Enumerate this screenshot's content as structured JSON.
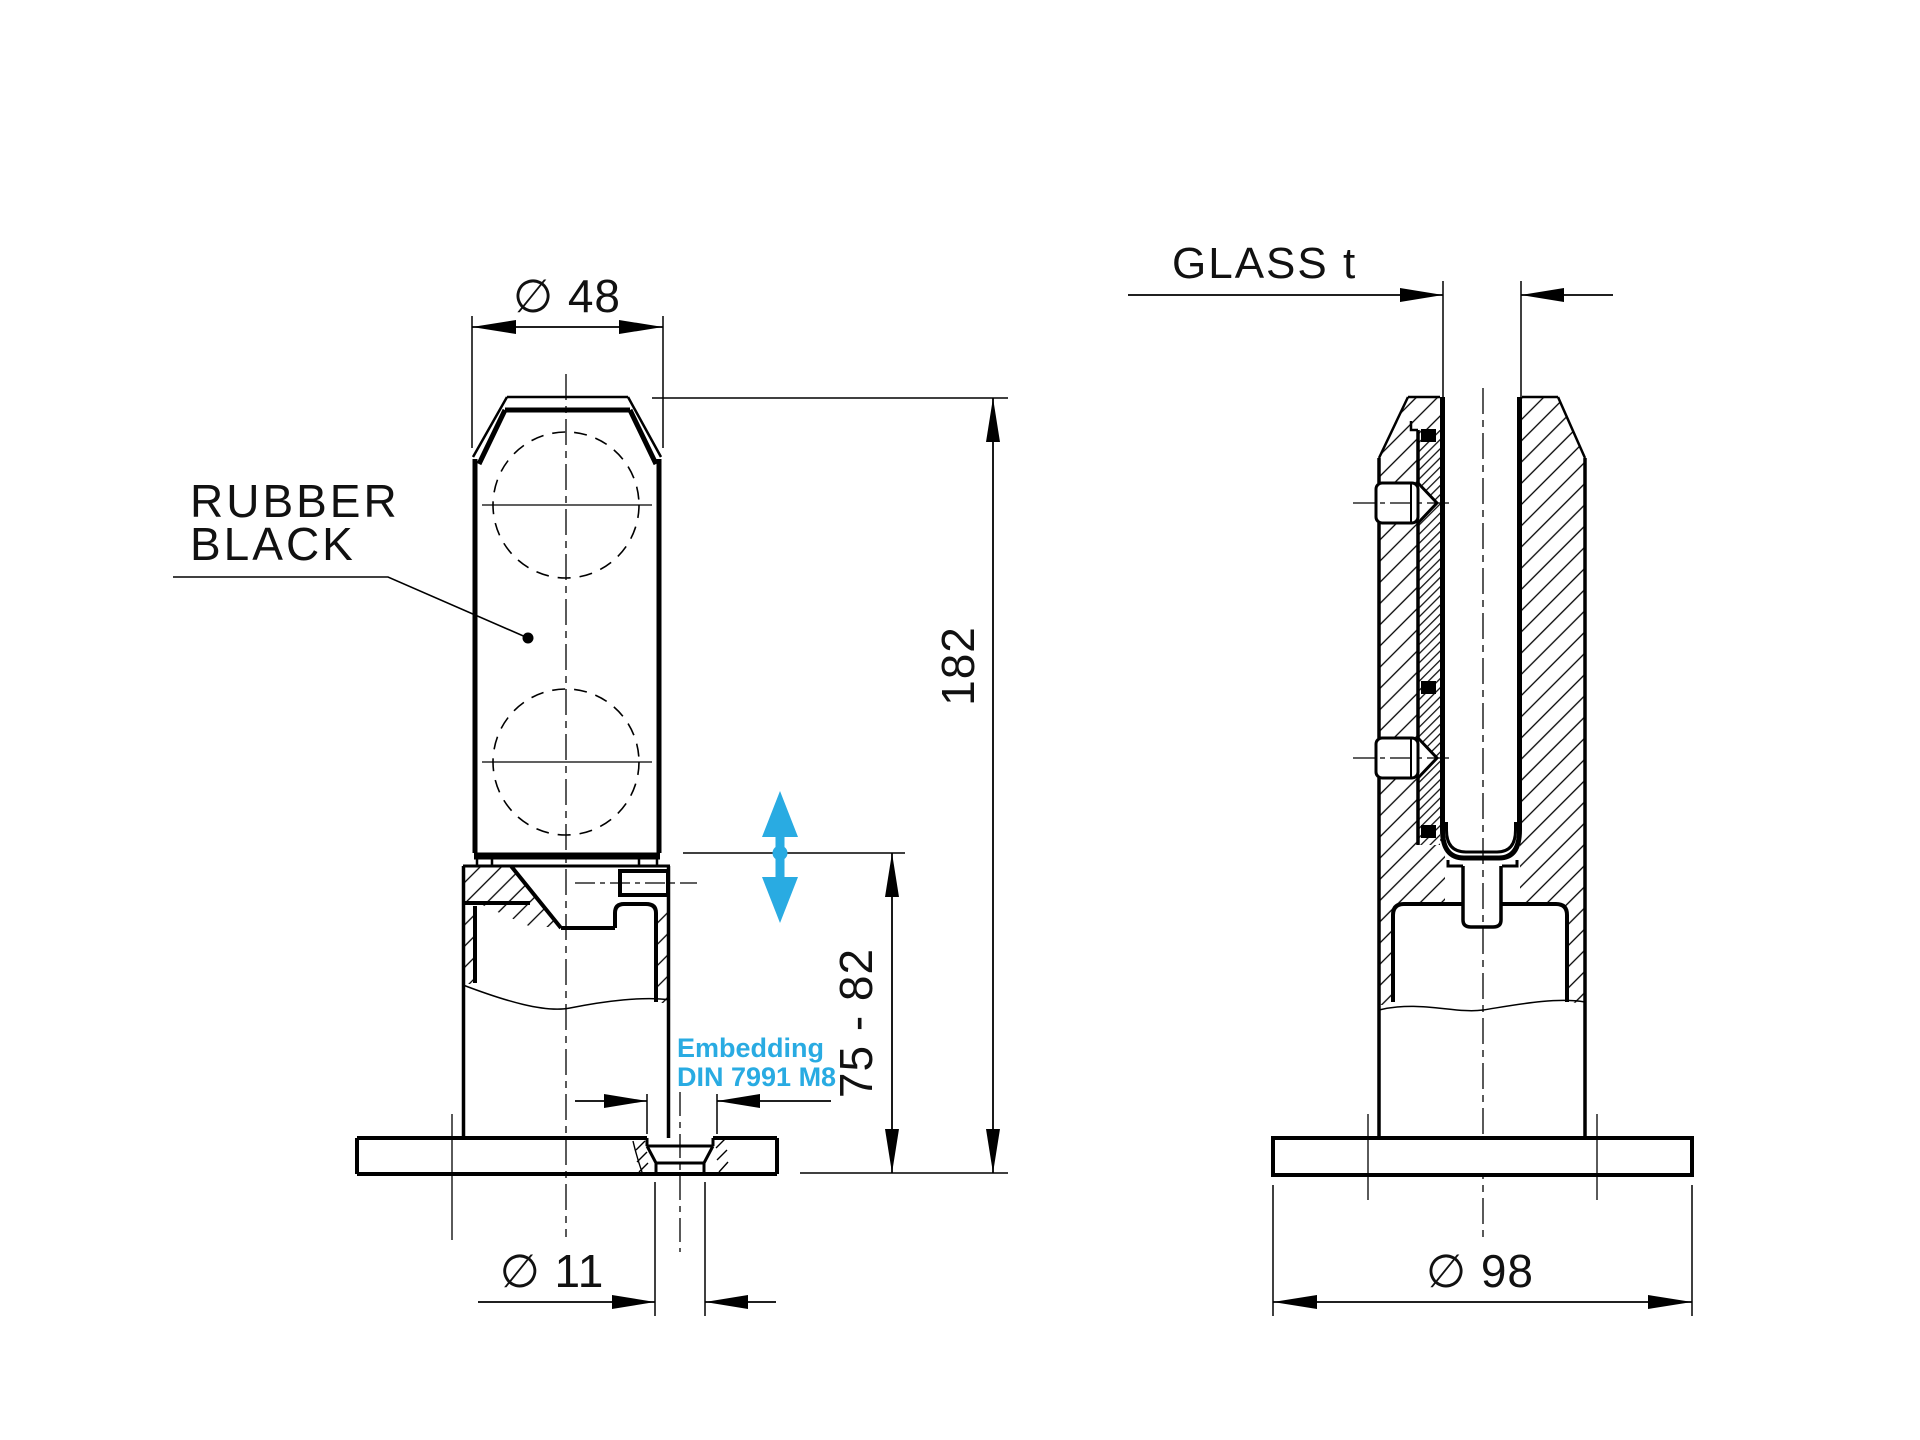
{
  "front_view": {
    "rubber_label_line1": "RUBBER",
    "rubber_label_line2": "BLACK",
    "dim_top_diameter": "∅ 48",
    "dim_height": "182",
    "dim_embed_range": "75 - 82",
    "dim_hole_diameter": "∅ 11",
    "embedding_note_line1": "Embedding",
    "embedding_note_line2": "DIN 7991 M8"
  },
  "side_view": {
    "dim_glass_thickness": "GLASS t",
    "dim_base_diameter": "∅ 98"
  },
  "colors": {
    "line": "#000000",
    "accent_cyan": "#29ABE2",
    "background": "#ffffff"
  }
}
